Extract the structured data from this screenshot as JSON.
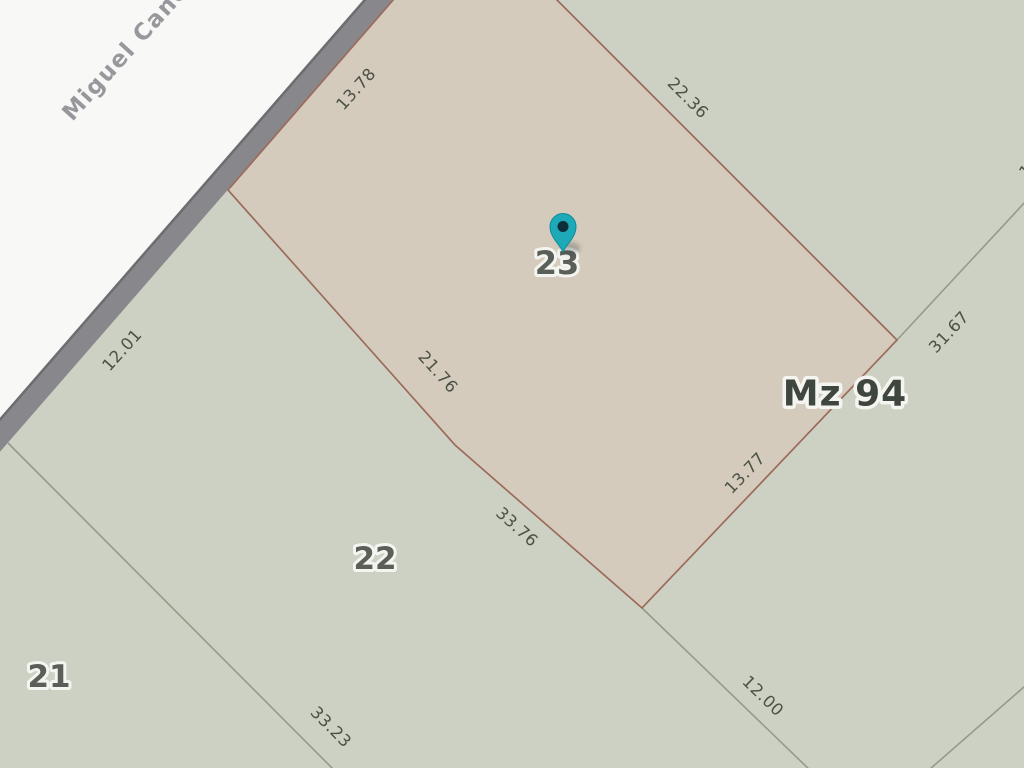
{
  "map_type": "cadastral-parcel-map",
  "street": {
    "name": "Miguel Cané"
  },
  "block": {
    "label": "Mz 94"
  },
  "marker": {
    "parcel_label": "23"
  },
  "parcels": [
    {
      "number": "21"
    },
    {
      "number": "22"
    },
    {
      "number": "23"
    }
  ],
  "dimensions": [
    {
      "value": "13.78",
      "edge": "parcel-23-street-frontage"
    },
    {
      "value": "22.36",
      "edge": "parcel-23-northeast-side"
    },
    {
      "value": "12.01",
      "edge": "parcel-22-street-frontage"
    },
    {
      "value": "21.76",
      "edge": "parcel-23-southwest-side"
    },
    {
      "value": "31.67",
      "edge": "adjacent-parcel-line-northeast"
    },
    {
      "value": "13.77",
      "edge": "parcel-23-southeast-side"
    },
    {
      "value": "33.76",
      "edge": "parcel-22-northeast-side"
    },
    {
      "value": "33.23",
      "edge": "parcel-21-22-boundary"
    },
    {
      "value": "12.00",
      "edge": "parcel-22-southeast-boundary"
    },
    {
      "value": "1",
      "edge": "clipped-label-right-edge"
    }
  ],
  "colors": {
    "street_fill": "#f8f8f7",
    "road_edge_band": "#88888c",
    "road_edge_dark": "#6d6d71",
    "block_fill": "#ccd1c3",
    "parcel_highlight_fill": "#d4cbbc",
    "parcel_highlight_stroke": "#9c6b5b",
    "parcel_line": "#939b8b",
    "dimension_text": "#4b5146",
    "parcel_number_text": "#5a5f58",
    "block_label_text": "#3f463e",
    "street_text": "#98989c",
    "halo": "#f4f4f1",
    "marker_fill": "#1da9b8",
    "marker_stroke": "#0f8a9b",
    "marker_dot": "#0d2e39"
  }
}
